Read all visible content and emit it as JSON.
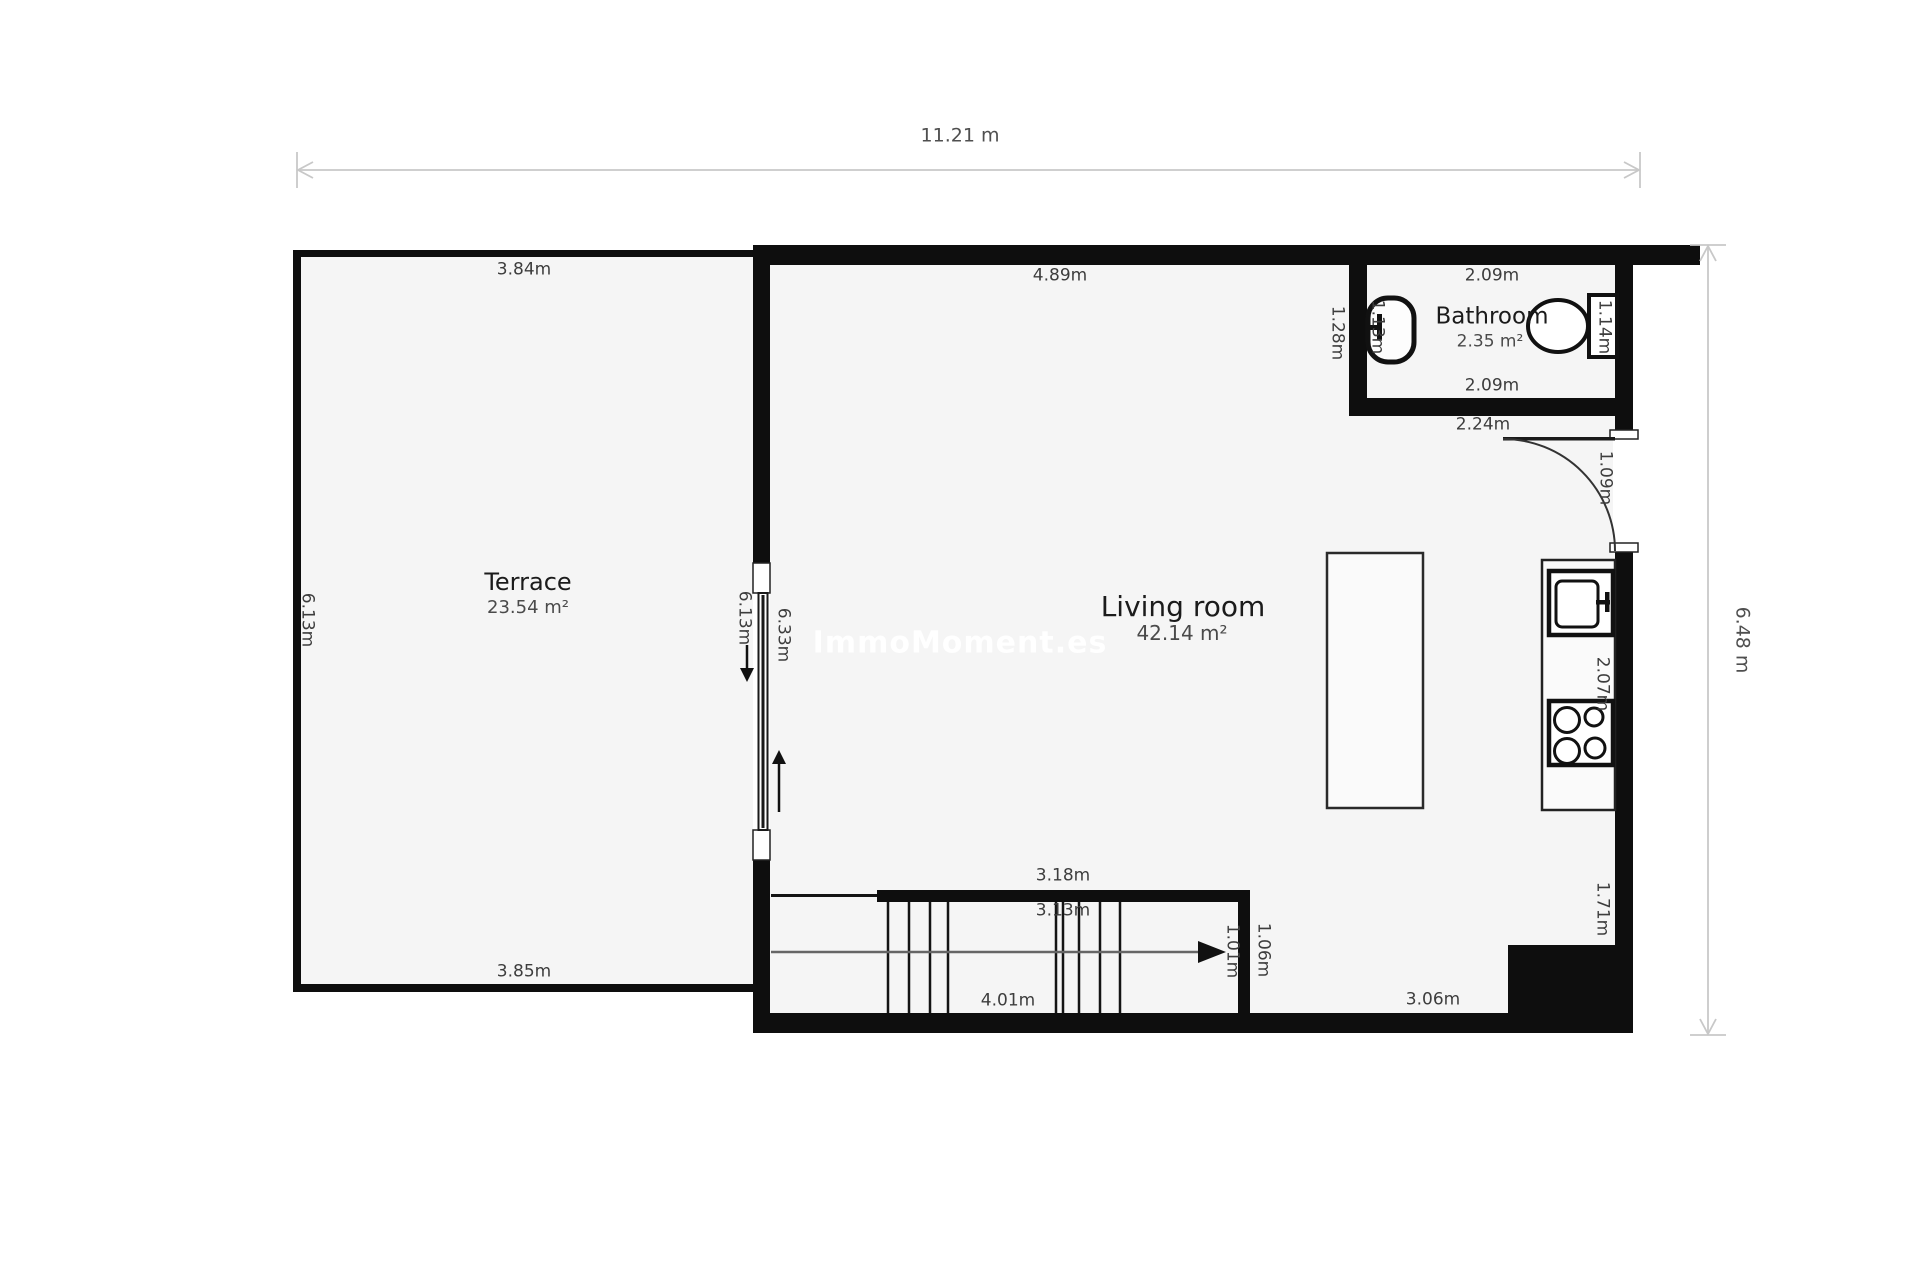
{
  "plan": {
    "watermark": "ImmoMoment.es",
    "overall": {
      "width_label": "11.21 m",
      "height_label": "6.48 m"
    },
    "rooms": {
      "terrace": {
        "name": "Terrace",
        "area": "23.54 m²",
        "dim_top": "3.84m",
        "dim_bottom": "3.85m",
        "dim_left": "6.13m",
        "dim_right": "6.13m"
      },
      "living_room": {
        "name": "Living room",
        "area": "42.14 m²",
        "dim_top": "4.89m",
        "dim_left": "6.33m",
        "dim_kitchen_counter": "2.07m",
        "dim_right_lower": "1.71m",
        "dim_bottom_right": "3.06m"
      },
      "bathroom": {
        "name": "Bathroom",
        "area": "2.35 m²",
        "dim_top": "2.09m",
        "dim_bottom": "2.09m",
        "dim_left": "1.28m",
        "dim_left_inner": "1.13m",
        "dim_right": "1.14m",
        "dim_wall_below": "2.24m"
      }
    },
    "stairs": {
      "dim_top_outer": "3.18m",
      "dim_top_inner": "3.13m",
      "dim_bottom": "4.01m",
      "dim_right_outer": "1.06m",
      "dim_right_inner": "1.01m"
    },
    "entry_door": {
      "dim": "1.09m"
    },
    "colors": {
      "wall": "#0e0e0e",
      "floor": "#f5f5f5",
      "dimension_line": "#c8c8c8",
      "label_text": "#3d3d3d",
      "watermark_text": "#ffffff"
    }
  }
}
